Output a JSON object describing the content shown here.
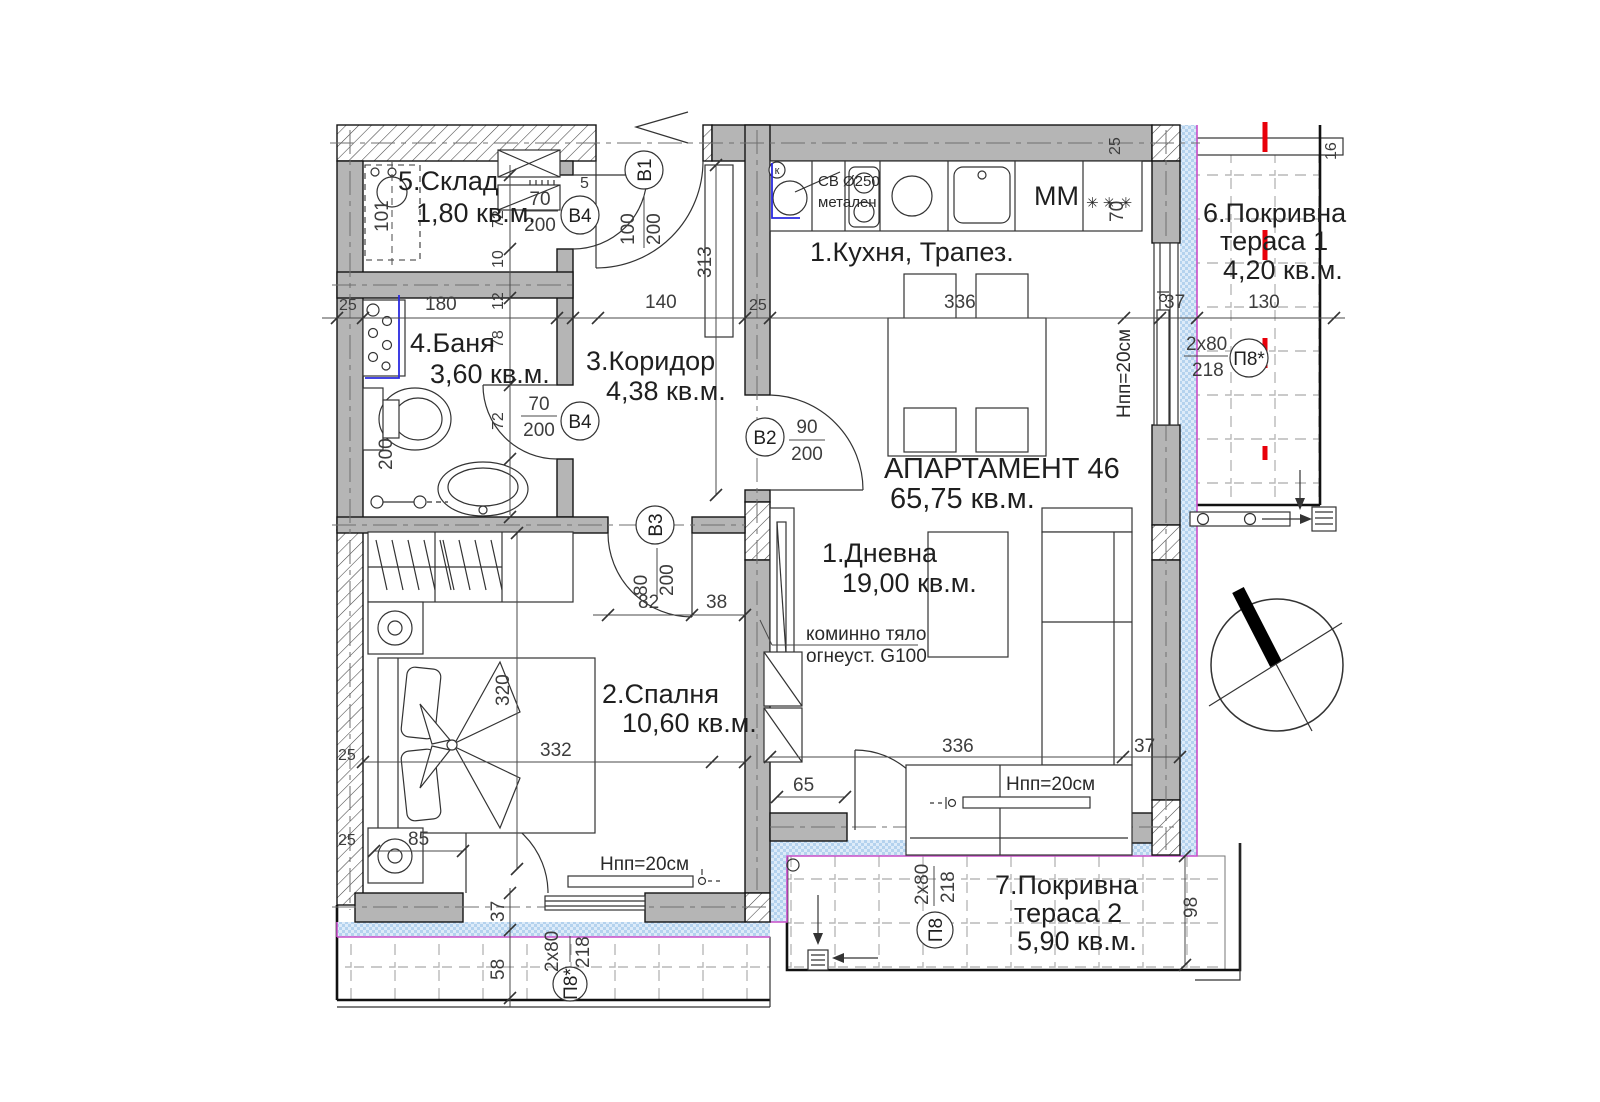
{
  "apartment": {
    "title": "АПАРТАМЕНТ 46",
    "area": "65,75 кв.м."
  },
  "rooms": {
    "kitchen": {
      "label": "1.Кухня, Трапез."
    },
    "living": {
      "label": "1.Дневна",
      "area": "19,00 кв.м."
    },
    "bedroom": {
      "label": "2.Спалня",
      "area": "10,60 кв.м."
    },
    "corridor": {
      "label": "3.Коридор",
      "area": "4,38 кв.м."
    },
    "bath": {
      "label": "4.Баня",
      "area": "3,60 кв.м."
    },
    "storage": {
      "label": "5.Склад",
      "area": "1,80 кв.м."
    },
    "terrace1": {
      "label1": "6.Покривна",
      "label2": "тераса 1",
      "area": "4,20 кв.м."
    },
    "terrace2": {
      "label1": "7.Покривна",
      "label2": "тераса 2",
      "area": "5,90 кв.м."
    }
  },
  "doors": {
    "b1": {
      "code": "В1",
      "w": "100",
      "h": "200"
    },
    "b2": {
      "code": "В2",
      "w": "90",
      "h": "200"
    },
    "b3": {
      "code": "В3",
      "w": "80",
      "h": "200"
    },
    "b4": {
      "code": "В4",
      "w": "70",
      "h": "200"
    }
  },
  "windows": {
    "p8": {
      "code": "П8",
      "size": "2x80",
      "sill": "218"
    },
    "p8s": {
      "code": "П8*",
      "size": "2x80",
      "sill": "218"
    }
  },
  "annotations": {
    "hpp": "Нпп=20см",
    "chimney1": "коминно тяло",
    "chimney2": "огнеуст. G100",
    "duct1": "СВ Ø250",
    "duct2": "метален",
    "mm": "ММ",
    "fridge": "✳ ✳ ✳",
    "k": "к"
  },
  "dims": {
    "d5": "5",
    "d10": "10",
    "d12": "12",
    "d16": "16",
    "d25": "25",
    "d37": "37",
    "d38": "38",
    "d58": "58",
    "d65": "65",
    "d70": "70",
    "d72": "72",
    "d78": "78",
    "d82": "82",
    "d85": "85",
    "d98": "98",
    "d101": "101",
    "d130": "130",
    "d140": "140",
    "d180": "180",
    "d200": "200",
    "d218": "218",
    "d313": "313",
    "d320": "320",
    "d332": "332",
    "d336": "336",
    "d2x80": "2x80"
  },
  "colors": {
    "wall_gray": "#b5b5b5",
    "insulation_blue": "#cfe3f6",
    "axis_red": "#e8000a",
    "waterproofing_magenta": "#c94fc9"
  }
}
